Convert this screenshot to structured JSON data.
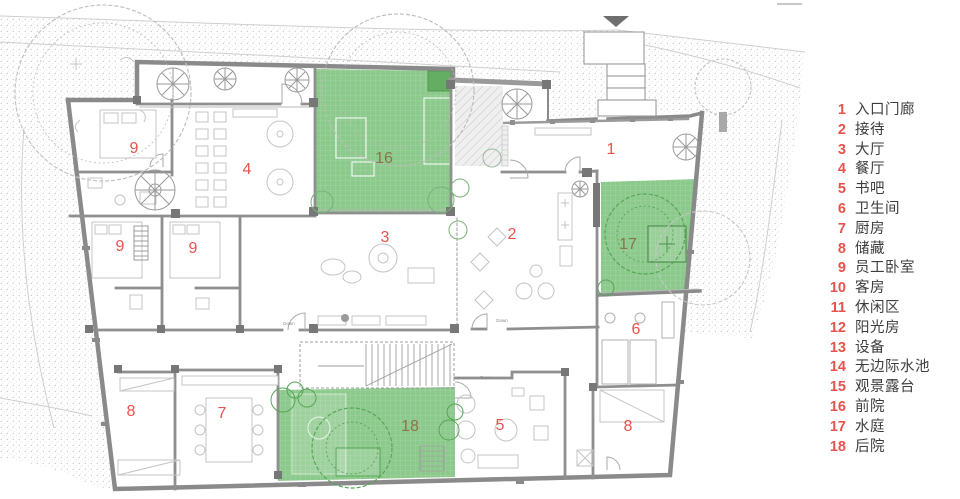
{
  "legend": {
    "items": [
      {
        "num": "1",
        "label": "入口门廊"
      },
      {
        "num": "2",
        "label": "接待"
      },
      {
        "num": "3",
        "label": "大厅"
      },
      {
        "num": "4",
        "label": "餐厅"
      },
      {
        "num": "5",
        "label": "书吧"
      },
      {
        "num": "6",
        "label": "卫生间"
      },
      {
        "num": "7",
        "label": "厨房"
      },
      {
        "num": "8",
        "label": "储藏"
      },
      {
        "num": "9",
        "label": "员工卧室"
      },
      {
        "num": "10",
        "label": "客房"
      },
      {
        "num": "11",
        "label": "休闲区"
      },
      {
        "num": "12",
        "label": "阳光房"
      },
      {
        "num": "13",
        "label": "设备"
      },
      {
        "num": "14",
        "label": "无边际水池"
      },
      {
        "num": "15",
        "label": "观景露台"
      },
      {
        "num": "16",
        "label": "前院"
      },
      {
        "num": "17",
        "label": "水庭"
      },
      {
        "num": "18",
        "label": "后院"
      }
    ]
  },
  "plan": {
    "room_labels": [
      {
        "num": "9",
        "x": 134,
        "y": 153,
        "variant": "red"
      },
      {
        "num": "4",
        "x": 247,
        "y": 174,
        "variant": "red"
      },
      {
        "num": "16",
        "x": 384,
        "y": 163,
        "variant": "green"
      },
      {
        "num": "1",
        "x": 611,
        "y": 154,
        "variant": "red"
      },
      {
        "num": "9",
        "x": 120,
        "y": 251,
        "variant": "red"
      },
      {
        "num": "9",
        "x": 193,
        "y": 253,
        "variant": "red"
      },
      {
        "num": "3",
        "x": 385,
        "y": 242,
        "variant": "red"
      },
      {
        "num": "2",
        "x": 512,
        "y": 239,
        "variant": "red"
      },
      {
        "num": "17",
        "x": 628,
        "y": 249,
        "variant": "green"
      },
      {
        "num": "6",
        "x": 636,
        "y": 334,
        "variant": "red"
      },
      {
        "num": "8",
        "x": 131,
        "y": 416,
        "variant": "red"
      },
      {
        "num": "7",
        "x": 222,
        "y": 418,
        "variant": "red"
      },
      {
        "num": "18",
        "x": 410,
        "y": 431,
        "variant": "green"
      },
      {
        "num": "5",
        "x": 500,
        "y": 430,
        "variant": "red"
      },
      {
        "num": "8",
        "x": 628,
        "y": 431,
        "variant": "red"
      }
    ],
    "down_labels": [
      {
        "text": "Down",
        "x": 289,
        "y": 325
      },
      {
        "text": "Down",
        "x": 502,
        "y": 322
      },
      {
        "text": "Down",
        "x": 486,
        "y": 379
      }
    ],
    "colors": {
      "red": "#e8524c",
      "green-label": "#8a7448",
      "wall": "#8a8a8a",
      "courtyard": "#8cc98c",
      "text": "#3d3d3d"
    }
  }
}
